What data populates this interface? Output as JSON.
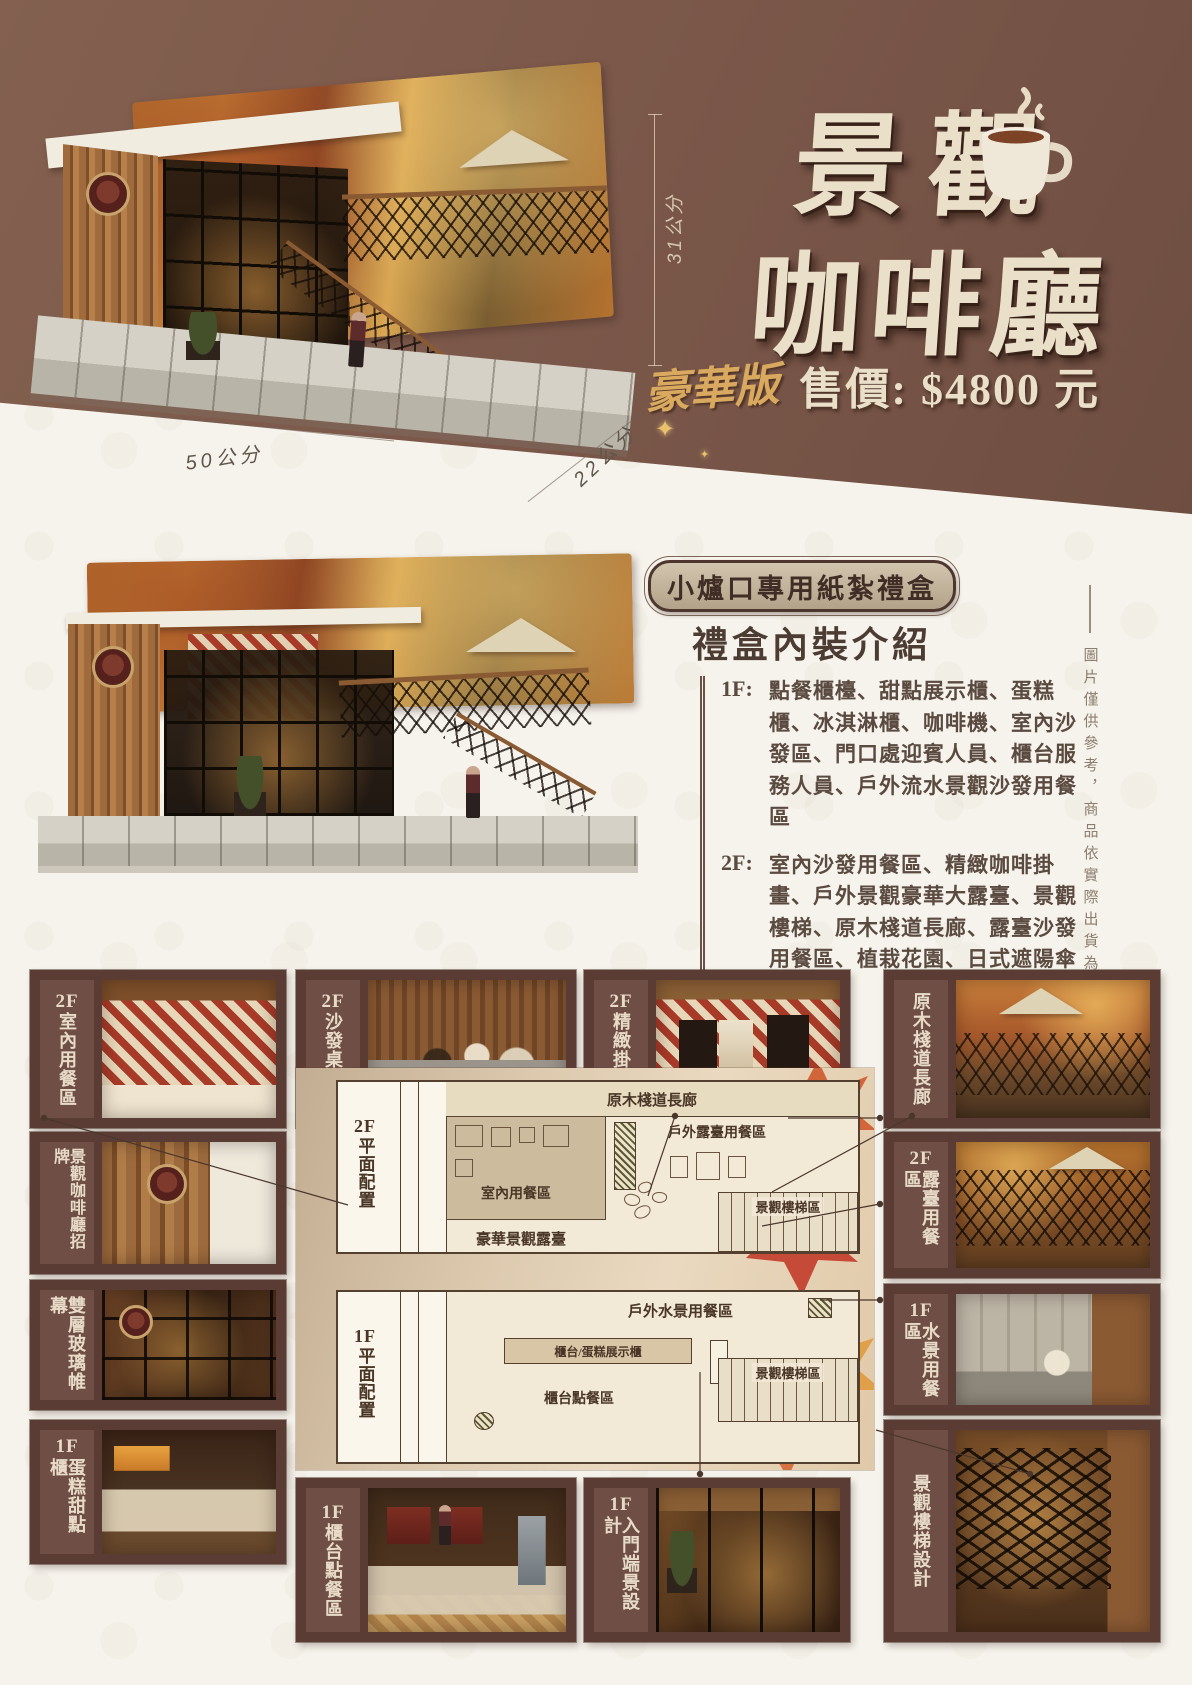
{
  "hero": {
    "title_line1": "景觀",
    "title_line2": "咖啡廳",
    "edition_label": "豪華版",
    "price_text": "售價: $4800 元",
    "dimensions": {
      "height": "31公分",
      "width": "50公分",
      "depth": "22公分"
    },
    "colors": {
      "background": "#7b584a",
      "title_text": "#eadfc9",
      "gold": "#d9a95f"
    }
  },
  "icons": {
    "sparkle": "✦",
    "coffee_cup": "coffee-cup"
  },
  "giftbox": {
    "badge": "小爐口專用紙紮禮盒",
    "heading": "禮盒內裝介紹",
    "floors": [
      {
        "label": "1F:",
        "items": "點餐櫃檯、甜點展示櫃、蛋糕櫃、冰淇淋櫃、咖啡機、室內沙發區、門口處迎賓人員、櫃台服務人員、戶外流水景觀沙發用餐區"
      },
      {
        "label": "2F:",
        "items": "室內沙發用餐區、精緻咖啡掛畫、戶外景觀豪華大露臺、景觀樓梯、原木棧道長廊、露臺沙發用餐區、植栽花園、日式遮陽傘"
      }
    ]
  },
  "disclaimer": "圖片僅供參考，商品依實際出貨為準",
  "gallery": {
    "cards": [
      {
        "prefix": "2F",
        "label": "室內用餐區"
      },
      {
        "prefix": "2F",
        "label": "沙發桌椅組"
      },
      {
        "prefix": "2F",
        "label": "精緻掛畫組"
      },
      {
        "prefix": "",
        "label": "原木棧道長廊"
      },
      {
        "prefix": "",
        "label": "景觀咖啡廳招牌"
      },
      {
        "prefix": "2F",
        "label": "露臺用餐區"
      },
      {
        "prefix": "",
        "label": "雙層玻璃帷幕"
      },
      {
        "prefix": "1F",
        "label": "水景用餐區"
      },
      {
        "prefix": "1F",
        "label": "蛋糕甜點櫃"
      },
      {
        "prefix": "1F",
        "label": "櫃台點餐區"
      },
      {
        "prefix": "1F",
        "label": "入門端景設計"
      },
      {
        "prefix": "",
        "label": "景觀樓梯設計"
      }
    ],
    "card_colors": {
      "frame": "#5a3c34",
      "label_strip": "#6f4e45",
      "label_text": "#e7dbc8"
    }
  },
  "floorplan": {
    "plan_2f": {
      "prefix": "2F",
      "side": "平面配置",
      "corridor": "原木棧道長廊",
      "terrace": "戶外露臺用餐區",
      "indoor": "室內用餐區",
      "lux_terrace": "豪華景觀露臺",
      "stairs": "景觀樓梯區"
    },
    "plan_1f": {
      "prefix": "1F",
      "side": "平面配置",
      "water": "戶外水景用餐區",
      "counter_display": "櫃台/蛋糕展示櫃",
      "counter_order": "櫃台點餐區",
      "stairs": "景觀樓梯區"
    }
  }
}
